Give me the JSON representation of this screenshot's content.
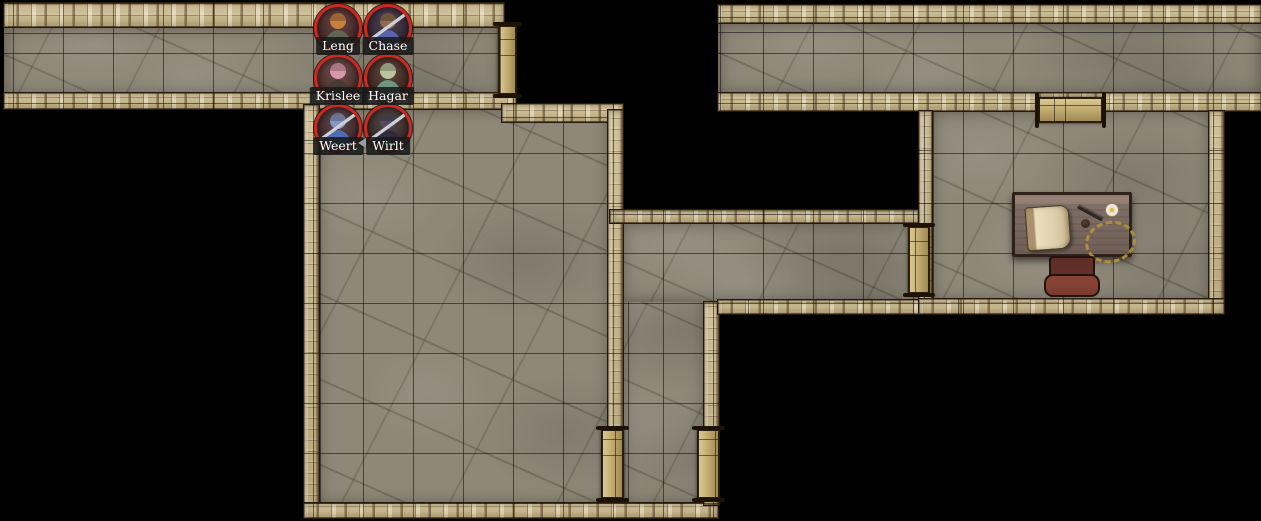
{
  "scene": {
    "name": "dungeon-battlemap",
    "background_color": "#000000",
    "grid": {
      "size": 50,
      "origin_x": 13,
      "origin_y": 3,
      "line_color": "rgba(0,0,0,0.5)"
    }
  },
  "palette": {
    "floor": "#8e8879",
    "wall": "#c6b48a",
    "door": "#c3ad72",
    "token_ring": "#c92a21",
    "label_bg": "rgba(25,25,25,0.88)",
    "label_text": "#ffffff",
    "desk_wood": "#6f5f57",
    "chair_red": "#7d3c31",
    "parchment": "#e0d2ae",
    "gold": "#b5943b"
  },
  "map": {
    "floors": [
      {
        "name": "west-corridor-floor",
        "x": 4,
        "y": 26,
        "w": 498,
        "h": 70
      },
      {
        "name": "east-corridor-floor",
        "x": 718,
        "y": 23,
        "w": 543,
        "h": 71
      },
      {
        "name": "great-hall-floor",
        "x": 317,
        "y": 108,
        "w": 293,
        "h": 397
      },
      {
        "name": "south-corridor-floor",
        "x": 621,
        "y": 222,
        "w": 85,
        "h": 283
      },
      {
        "name": "mid-corridor-floor",
        "x": 621,
        "y": 222,
        "w": 299,
        "h": 80
      },
      {
        "name": "study-room-floor",
        "x": 931,
        "y": 110,
        "w": 280,
        "h": 192
      }
    ],
    "walls": [
      {
        "x": 4,
        "y": 3,
        "w": 500,
        "h": 24
      },
      {
        "x": 4,
        "y": 93,
        "w": 512,
        "h": 16
      },
      {
        "x": 304,
        "y": 105,
        "w": 15,
        "h": 413
      },
      {
        "x": 502,
        "y": 104,
        "w": 121,
        "h": 18
      },
      {
        "x": 608,
        "y": 110,
        "w": 15,
        "h": 394
      },
      {
        "x": 304,
        "y": 503,
        "w": 414,
        "h": 15
      },
      {
        "x": 704,
        "y": 302,
        "w": 15,
        "h": 203
      },
      {
        "x": 610,
        "y": 210,
        "w": 315,
        "h": 13
      },
      {
        "x": 718,
        "y": 300,
        "w": 215,
        "h": 14
      },
      {
        "x": 718,
        "y": 5,
        "w": 543,
        "h": 18
      },
      {
        "x": 718,
        "y": 93,
        "w": 543,
        "h": 18
      },
      {
        "x": 919,
        "y": 111,
        "w": 13,
        "h": 203
      },
      {
        "x": 1209,
        "y": 111,
        "w": 15,
        "h": 203
      },
      {
        "x": 919,
        "y": 299,
        "w": 305,
        "h": 15
      }
    ],
    "doors": [
      {
        "name": "door-west-corridor-east",
        "x": 498,
        "y": 25,
        "w": 19,
        "h": 70,
        "dir": "v"
      },
      {
        "name": "door-study-north",
        "x": 1038,
        "y": 97,
        "w": 65,
        "h": 26,
        "dir": "h"
      },
      {
        "name": "door-study-west",
        "x": 908,
        "y": 226,
        "w": 22,
        "h": 68,
        "dir": "v"
      },
      {
        "name": "door-hall-east",
        "x": 601,
        "y": 429,
        "w": 23,
        "h": 70,
        "dir": "v"
      },
      {
        "name": "door-south-corridor-east",
        "x": 697,
        "y": 429,
        "w": 23,
        "h": 70,
        "dir": "v"
      }
    ]
  },
  "furniture": {
    "desk": {
      "x": 1012,
      "y": 192,
      "w": 120,
      "h": 65
    },
    "scroll": {
      "x": 1026,
      "y": 206,
      "w": 44,
      "h": 44
    },
    "quill": {
      "x": 1076,
      "y": 212,
      "w": 28,
      "h": 3
    },
    "ink_knob": {
      "x": 1081,
      "y": 219,
      "w": 9,
      "h": 9
    },
    "candle": {
      "x": 1105,
      "y": 203,
      "w": 12,
      "h": 12
    },
    "rope_coil": {
      "x": 1085,
      "y": 221,
      "w": 45,
      "h": 36
    },
    "chair": {
      "x": 1044,
      "y": 256,
      "w": 56,
      "h": 41
    }
  },
  "tokens": [
    {
      "label": "Leng",
      "x": 314,
      "y": 4,
      "size": 48,
      "bg": "#4e2527",
      "head": "#c8803f",
      "body": "#5f6654",
      "weapon": false,
      "marker": false
    },
    {
      "label": "Chase",
      "x": 364,
      "y": 4,
      "size": 48,
      "bg": "#352338",
      "head": "#8d6b4e",
      "body": "#5b63ab",
      "weapon": true,
      "marker": false
    },
    {
      "label": "Krislee",
      "x": 314,
      "y": 54,
      "size": 48,
      "bg": "#56302c",
      "head": "#d898ab",
      "body": "#463c31",
      "weapon": false,
      "marker": false
    },
    {
      "label": "Hagar",
      "x": 364,
      "y": 54,
      "size": 48,
      "bg": "#45271f",
      "head": "#b9c49c",
      "body": "#6f9480",
      "weapon": false,
      "marker": false
    },
    {
      "label": "Weert",
      "x": 314,
      "y": 104,
      "size": 48,
      "bg": "#44292c",
      "head": "#8795c2",
      "body": "#4f6cb5",
      "weapon": true,
      "marker": false
    },
    {
      "label": "Wirlt",
      "x": 364,
      "y": 104,
      "size": 48,
      "bg": "#3a2a26",
      "head": "#554b5c",
      "body": "#302b3a",
      "weapon": true,
      "marker": true
    }
  ]
}
